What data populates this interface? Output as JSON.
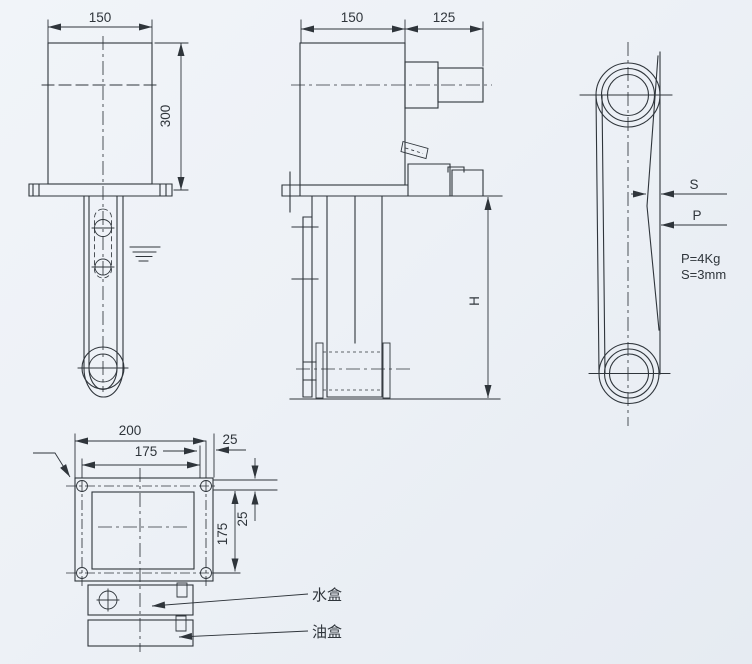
{
  "colors": {
    "background": "#edf1f6",
    "line": "#2f353b"
  },
  "front_view": {
    "width": "150",
    "height": "300"
  },
  "side_view": {
    "body_width": "150",
    "shaft_length": "125",
    "depth": "H"
  },
  "belt_view": {
    "deflection": "S",
    "force": "P",
    "force_note": "P=4Kg",
    "deflection_note": "S=3mm"
  },
  "plan_view": {
    "overall_width": "200",
    "hole_pitch_x": "175",
    "edge_offset_x": "25",
    "hole_pitch_y": "175",
    "edge_offset_y": "25",
    "water_box": "水盒",
    "oil_box": "油盒"
  }
}
